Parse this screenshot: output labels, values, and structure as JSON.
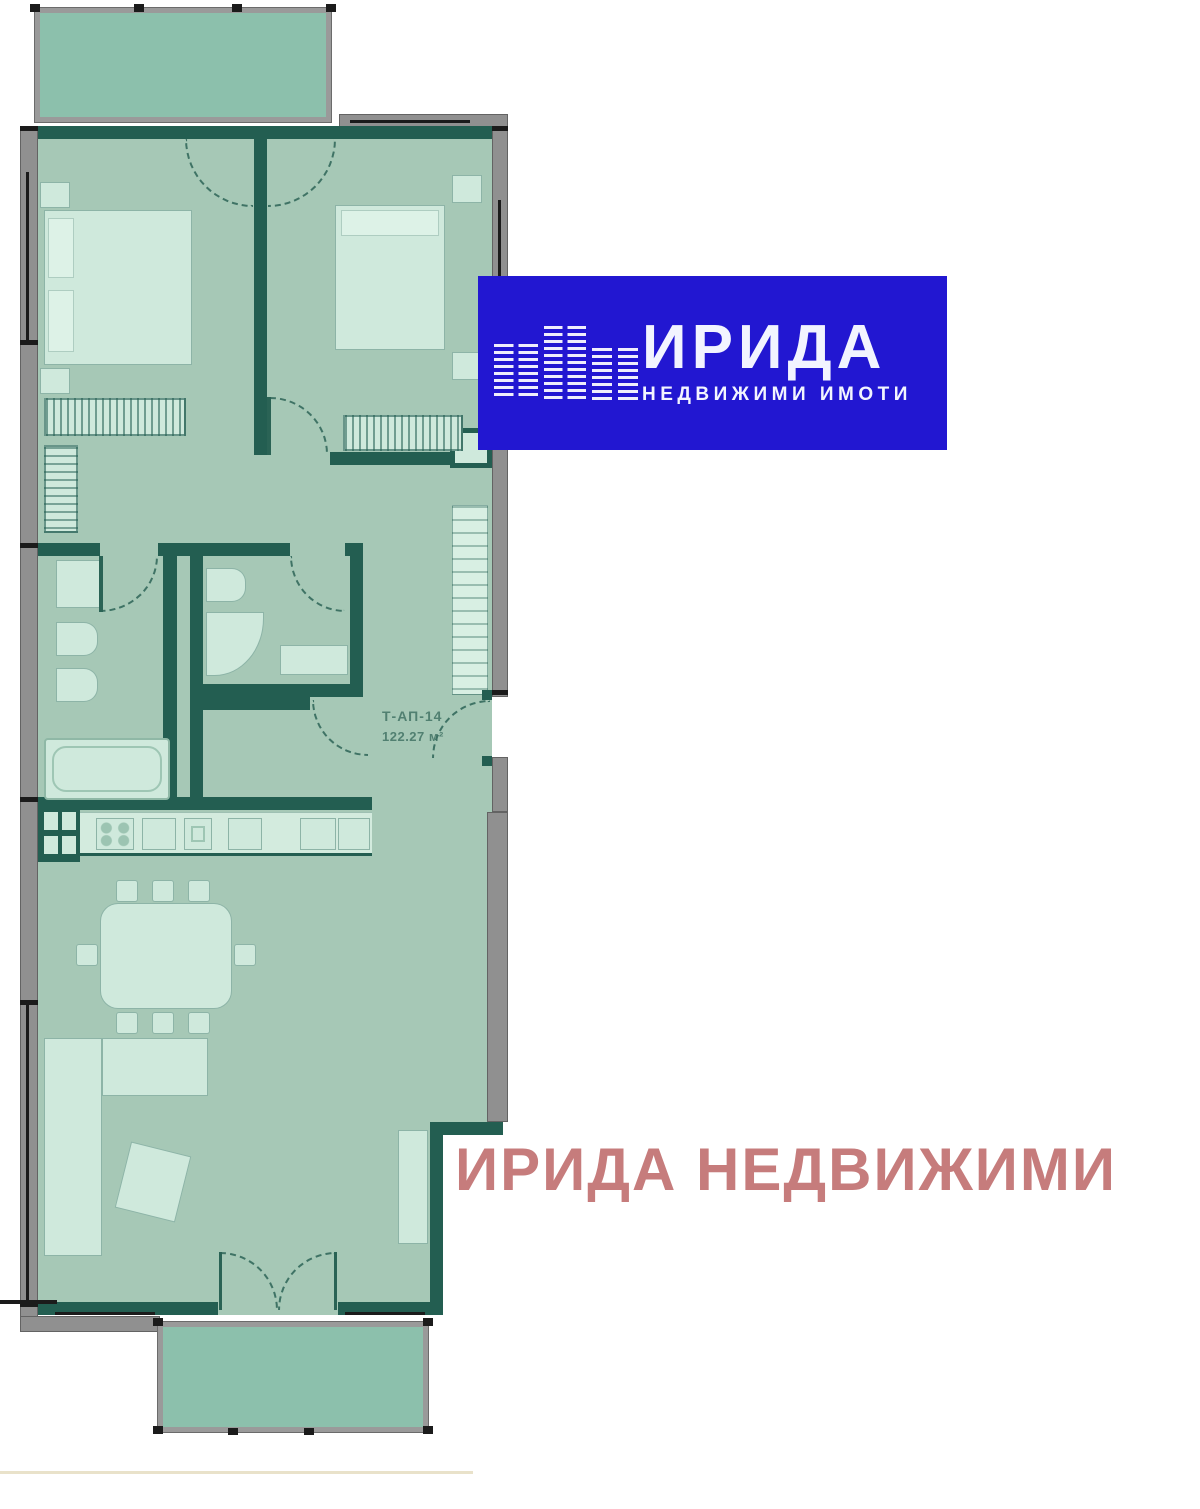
{
  "logo": {
    "title": "ИРИДА",
    "subtitle": "НЕДВИЖИМИ ИМОТИ",
    "bg_color": "#2217d1",
    "text_color": "#f2f4ff"
  },
  "watermark": {
    "text": "ИРИДА НЕДВИЖИМИ",
    "color": "#c67c7c"
  },
  "plan": {
    "unit_label": "Т-АП-14",
    "area_label": "122.27 м²",
    "colors": {
      "room_fill": "#a6c8b6",
      "balcony_fill": "#8cc0ac",
      "furniture_fill": "#cfe9dc",
      "wall_teal": "#235e51",
      "wall_grey": "#909090",
      "arc_color": "#3f7365",
      "label_color": "#3f7163"
    }
  }
}
